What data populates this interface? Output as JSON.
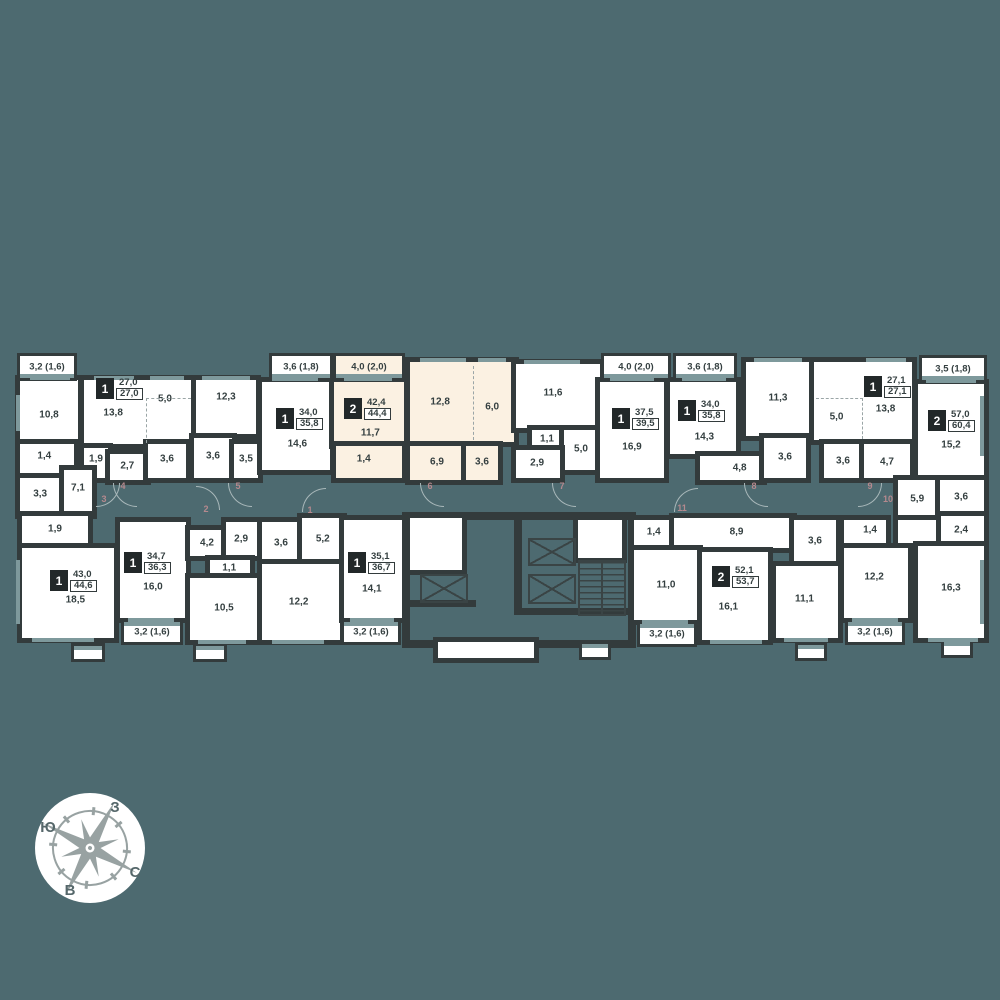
{
  "colors": {
    "bg": "#4d6a70",
    "wall": "#333b3c",
    "room": "#ffffff",
    "highlight": "#fbf1e2",
    "window": "#7e999c",
    "label": "#343f40",
    "flat_number": "#b5898e",
    "compass_star": "#98a2a2",
    "compass_text": "#55676a"
  },
  "highlighted_apartment": {
    "rooms_count": "2",
    "living_area": "42,4",
    "total_area": "44,4"
  },
  "plan": {
    "walls": [
      {
        "x": 402,
        "y": 512,
        "w": 234,
        "h": 8
      },
      {
        "x": 402,
        "y": 512,
        "w": 8,
        "h": 136
      },
      {
        "x": 628,
        "y": 512,
        "w": 8,
        "h": 136
      },
      {
        "x": 402,
        "y": 640,
        "w": 234,
        "h": 8
      },
      {
        "x": 514,
        "y": 512,
        "w": 8,
        "h": 96
      },
      {
        "x": 514,
        "y": 608,
        "w": 122,
        "h": 7
      },
      {
        "x": 404,
        "y": 600,
        "w": 72,
        "h": 7
      }
    ],
    "rooms": [
      {
        "x": 20,
        "y": 380,
        "w": 58,
        "h": 62,
        "l": [
          [
            "10,8",
            50,
            56
          ]
        ]
      },
      {
        "x": 84,
        "y": 380,
        "w": 108,
        "h": 64,
        "l": [
          [
            "13,8",
            27,
            52
          ],
          [
            "5,0",
            75,
            30
          ]
        ]
      },
      {
        "x": 196,
        "y": 380,
        "w": 60,
        "h": 54,
        "l": [
          [
            "12,3",
            50,
            32
          ]
        ]
      },
      {
        "x": 20,
        "y": 444,
        "w": 54,
        "h": 30,
        "l": [
          [
            "1,4",
            45,
            40
          ]
        ]
      },
      {
        "x": 84,
        "y": 448,
        "w": 24,
        "h": 30,
        "l": [
          [
            "1,9",
            50,
            35
          ]
        ]
      },
      {
        "x": 110,
        "y": 454,
        "w": 36,
        "h": 26,
        "l": [
          [
            "2,7",
            48,
            45
          ]
        ]
      },
      {
        "x": 148,
        "y": 444,
        "w": 38,
        "h": 34,
        "l": [
          [
            "3,6",
            50,
            45
          ]
        ]
      },
      {
        "x": 194,
        "y": 438,
        "w": 38,
        "h": 40,
        "l": [
          [
            "3,6",
            50,
            45
          ]
        ]
      },
      {
        "x": 234,
        "y": 444,
        "w": 24,
        "h": 34,
        "l": [
          [
            "3,5",
            50,
            45
          ]
        ]
      },
      {
        "x": 20,
        "y": 478,
        "w": 42,
        "h": 36,
        "l": [
          [
            "3,3",
            48,
            45
          ]
        ]
      },
      {
        "x": 64,
        "y": 470,
        "w": 28,
        "h": 44,
        "l": [
          [
            "7,1",
            50,
            40
          ]
        ]
      },
      {
        "x": 262,
        "y": 382,
        "w": 68,
        "h": 88,
        "l": [
          [
            "14,6",
            52,
            70
          ]
        ]
      },
      {
        "x": 334,
        "y": 382,
        "w": 70,
        "h": 62,
        "f": "b",
        "l": [
          [
            "11,7",
            52,
            82
          ]
        ]
      },
      {
        "x": 336,
        "y": 446,
        "w": 66,
        "h": 32,
        "f": "b",
        "l": [
          [
            "1,4",
            42,
            40
          ]
        ]
      },
      {
        "x": 410,
        "y": 362,
        "w": 104,
        "h": 80,
        "f": "b",
        "l": [
          [
            "12,8",
            29,
            50
          ],
          [
            "6,0",
            79,
            56
          ]
        ]
      },
      {
        "x": 410,
        "y": 446,
        "w": 54,
        "h": 34,
        "f": "b",
        "l": [
          [
            "6,9",
            50,
            48
          ]
        ]
      },
      {
        "x": 466,
        "y": 446,
        "w": 32,
        "h": 34,
        "f": "b",
        "l": [
          [
            "3,6",
            50,
            48
          ]
        ]
      },
      {
        "x": 516,
        "y": 364,
        "w": 84,
        "h": 64,
        "l": [
          [
            "11,6",
            44,
            45
          ]
        ]
      },
      {
        "x": 532,
        "y": 430,
        "w": 30,
        "h": 18,
        "l": [
          [
            "1,1",
            50,
            50
          ]
        ]
      },
      {
        "x": 564,
        "y": 430,
        "w": 34,
        "h": 40,
        "l": [
          [
            "5,0",
            50,
            48
          ]
        ]
      },
      {
        "x": 516,
        "y": 450,
        "w": 44,
        "h": 28,
        "l": [
          [
            "2,9",
            48,
            46
          ]
        ]
      },
      {
        "x": 600,
        "y": 382,
        "w": 64,
        "h": 96,
        "l": [
          [
            "16,9",
            50,
            68
          ]
        ]
      },
      {
        "x": 670,
        "y": 382,
        "w": 66,
        "h": 72,
        "l": [
          [
            "14,3",
            52,
            76
          ]
        ]
      },
      {
        "x": 700,
        "y": 456,
        "w": 62,
        "h": 24,
        "l": [
          [
            "4,8",
            64,
            48
          ]
        ]
      },
      {
        "x": 746,
        "y": 362,
        "w": 64,
        "h": 74,
        "l": [
          [
            "11,3",
            50,
            48
          ]
        ]
      },
      {
        "x": 764,
        "y": 438,
        "w": 42,
        "h": 40,
        "l": [
          [
            "3,6",
            50,
            48
          ]
        ]
      },
      {
        "x": 814,
        "y": 362,
        "w": 98,
        "h": 78,
        "l": [
          [
            "5,0",
            23,
            70
          ],
          [
            "13,8",
            73,
            60
          ]
        ]
      },
      {
        "x": 824,
        "y": 444,
        "w": 38,
        "h": 34,
        "l": [
          [
            "3,6",
            50,
            50
          ]
        ]
      },
      {
        "x": 864,
        "y": 444,
        "w": 46,
        "h": 34,
        "l": [
          [
            "4,7",
            50,
            52
          ]
        ]
      },
      {
        "x": 918,
        "y": 384,
        "w": 66,
        "h": 92,
        "l": [
          [
            "15,2",
            50,
            66
          ]
        ]
      },
      {
        "x": 898,
        "y": 480,
        "w": 40,
        "h": 36,
        "l": [
          [
            "5,9",
            48,
            52
          ]
        ]
      },
      {
        "x": 940,
        "y": 480,
        "w": 44,
        "h": 34,
        "l": [
          [
            "3,6",
            48,
            50
          ]
        ]
      },
      {
        "x": 940,
        "y": 516,
        "w": 44,
        "h": 26,
        "l": [
          [
            "2,4",
            48,
            52
          ]
        ]
      },
      {
        "x": 898,
        "y": 520,
        "w": 38,
        "h": 24,
        "l": []
      },
      {
        "x": 918,
        "y": 546,
        "w": 66,
        "h": 92,
        "l": [
          [
            "16,3",
            50,
            46
          ]
        ]
      },
      {
        "x": 22,
        "y": 516,
        "w": 66,
        "h": 28,
        "l": [
          [
            "1,9",
            50,
            48
          ]
        ]
      },
      {
        "x": 22,
        "y": 548,
        "w": 92,
        "h": 90,
        "l": [
          [
            "18,5",
            58,
            58
          ]
        ]
      },
      {
        "x": 120,
        "y": 522,
        "w": 66,
        "h": 96,
        "l": [
          [
            "16,0",
            50,
            68
          ]
        ]
      },
      {
        "x": 190,
        "y": 530,
        "w": 34,
        "h": 26,
        "l": [
          [
            "4,2",
            50,
            50
          ]
        ]
      },
      {
        "x": 226,
        "y": 522,
        "w": 36,
        "h": 34,
        "l": [
          [
            "2,9",
            42,
            50
          ]
        ]
      },
      {
        "x": 210,
        "y": 560,
        "w": 40,
        "h": 16,
        "l": [
          [
            "1,1",
            48,
            50
          ]
        ]
      },
      {
        "x": 190,
        "y": 578,
        "w": 68,
        "h": 62,
        "l": [
          [
            "10,5",
            50,
            48
          ]
        ]
      },
      {
        "x": 262,
        "y": 522,
        "w": 38,
        "h": 40,
        "l": [
          [
            "3,6",
            50,
            52
          ]
        ]
      },
      {
        "x": 302,
        "y": 518,
        "w": 40,
        "h": 42,
        "l": [
          [
            "5,2",
            52,
            50
          ]
        ]
      },
      {
        "x": 262,
        "y": 564,
        "w": 78,
        "h": 76,
        "l": [
          [
            "12,2",
            47,
            50
          ]
        ]
      },
      {
        "x": 344,
        "y": 520,
        "w": 58,
        "h": 98,
        "l": [
          [
            "14,1",
            48,
            70
          ]
        ]
      },
      {
        "x": 410,
        "y": 518,
        "w": 52,
        "h": 52,
        "l": []
      },
      {
        "x": 578,
        "y": 520,
        "w": 44,
        "h": 38,
        "l": []
      },
      {
        "x": 438,
        "y": 642,
        "w": 96,
        "h": 16,
        "l": []
      },
      {
        "x": 634,
        "y": 520,
        "w": 38,
        "h": 26,
        "l": [
          [
            "1,4",
            52,
            45
          ]
        ]
      },
      {
        "x": 674,
        "y": 518,
        "w": 118,
        "h": 30,
        "l": [
          [
            "8,9",
            53,
            48
          ]
        ]
      },
      {
        "x": 634,
        "y": 550,
        "w": 64,
        "h": 70,
        "l": [
          [
            "11,0",
            50,
            50
          ]
        ]
      },
      {
        "x": 702,
        "y": 552,
        "w": 66,
        "h": 88,
        "l": [
          [
            "16,1",
            40,
            62
          ]
        ]
      },
      {
        "x": 794,
        "y": 520,
        "w": 42,
        "h": 42,
        "l": [
          [
            "3,6",
            50,
            50
          ]
        ]
      },
      {
        "x": 776,
        "y": 566,
        "w": 62,
        "h": 72,
        "l": [
          [
            "11,1",
            46,
            46
          ]
        ]
      },
      {
        "x": 844,
        "y": 520,
        "w": 42,
        "h": 24,
        "l": [
          [
            "1,4",
            62,
            42
          ]
        ]
      },
      {
        "x": 844,
        "y": 548,
        "w": 64,
        "h": 70,
        "l": [
          [
            "12,2",
            47,
            42
          ]
        ]
      }
    ],
    "balconies": [
      {
        "t": "3,2 (1,6)",
        "x": 20,
        "y": 356,
        "w": 54,
        "h": 22,
        "side": "bottom"
      },
      {
        "t": "3,6 (1,8)",
        "x": 272,
        "y": 356,
        "w": 58,
        "h": 22,
        "side": "bottom"
      },
      {
        "t": "4,0 (2,0)",
        "x": 336,
        "y": 356,
        "w": 66,
        "h": 22,
        "side": "bottom",
        "hl": 1
      },
      {
        "t": "4,0 (2,0)",
        "x": 604,
        "y": 356,
        "w": 64,
        "h": 22,
        "side": "bottom"
      },
      {
        "t": "3,6 (1,8)",
        "x": 676,
        "y": 356,
        "w": 58,
        "h": 22,
        "side": "bottom"
      },
      {
        "t": "3,5 (1,8)",
        "x": 922,
        "y": 358,
        "w": 62,
        "h": 22,
        "side": "bottom"
      },
      {
        "t": "3,2 (1,6)",
        "x": 124,
        "y": 622,
        "w": 56,
        "h": 20,
        "side": "top"
      },
      {
        "t": "3,2 (1,6)",
        "x": 344,
        "y": 622,
        "w": 54,
        "h": 20,
        "side": "top"
      },
      {
        "t": "3,2 (1,6)",
        "x": 640,
        "y": 624,
        "w": 54,
        "h": 20,
        "side": "top"
      },
      {
        "t": "3,2 (1,6)",
        "x": 848,
        "y": 622,
        "w": 54,
        "h": 20,
        "side": "top"
      },
      {
        "t": "",
        "x": 74,
        "y": 646,
        "w": 28,
        "h": 13,
        "side": "top"
      },
      {
        "t": "",
        "x": 196,
        "y": 646,
        "w": 28,
        "h": 13,
        "side": "top"
      },
      {
        "t": "",
        "x": 582,
        "y": 644,
        "w": 26,
        "h": 13,
        "side": "top"
      },
      {
        "t": "",
        "x": 798,
        "y": 645,
        "w": 26,
        "h": 13,
        "side": "top"
      },
      {
        "t": "",
        "x": 944,
        "y": 642,
        "w": 26,
        "h": 13,
        "side": "top"
      }
    ],
    "badges": [
      {
        "n": "1",
        "a": "27,0",
        "tot": "27,0",
        "x": 96,
        "y": 378
      },
      {
        "n": "1",
        "a": "34,0",
        "tot": "35,8",
        "x": 276,
        "y": 408
      },
      {
        "n": "2",
        "a": "42,4",
        "tot": "44,4",
        "x": 344,
        "y": 398,
        "hl": 1
      },
      {
        "n": "1",
        "a": "37,5",
        "tot": "39,5",
        "x": 612,
        "y": 408
      },
      {
        "n": "1",
        "a": "34,0",
        "tot": "35,8",
        "x": 678,
        "y": 400
      },
      {
        "n": "1",
        "a": "27,1",
        "tot": "27,1",
        "x": 864,
        "y": 376
      },
      {
        "n": "2",
        "a": "57,0",
        "tot": "60,4",
        "x": 928,
        "y": 410
      },
      {
        "n": "1",
        "a": "43,0",
        "tot": "44,6",
        "x": 50,
        "y": 570
      },
      {
        "n": "1",
        "a": "34,7",
        "tot": "36,3",
        "x": 124,
        "y": 552
      },
      {
        "n": "1",
        "a": "35,1",
        "tot": "36,7",
        "x": 348,
        "y": 552
      },
      {
        "n": "2",
        "a": "52,1",
        "tot": "53,7",
        "x": 712,
        "y": 566
      }
    ],
    "flat_numbers": [
      {
        "n": "3",
        "x": 104,
        "y": 499
      },
      {
        "n": "4",
        "x": 123,
        "y": 486
      },
      {
        "n": "2",
        "x": 206,
        "y": 509
      },
      {
        "n": "5",
        "x": 238,
        "y": 486
      },
      {
        "n": "1",
        "x": 310,
        "y": 510
      },
      {
        "n": "6",
        "x": 430,
        "y": 486
      },
      {
        "n": "7",
        "x": 562,
        "y": 486
      },
      {
        "n": "11",
        "x": 682,
        "y": 508
      },
      {
        "n": "8",
        "x": 754,
        "y": 486
      },
      {
        "n": "9",
        "x": 870,
        "y": 486
      },
      {
        "n": "10",
        "x": 888,
        "y": 499
      }
    ],
    "windows": [
      {
        "x": 30,
        "y": 376,
        "w": 40,
        "h": 4
      },
      {
        "x": 94,
        "y": 376,
        "w": 40,
        "h": 4
      },
      {
        "x": 150,
        "y": 376,
        "w": 34,
        "h": 4
      },
      {
        "x": 202,
        "y": 376,
        "w": 48,
        "h": 4
      },
      {
        "x": 272,
        "y": 377,
        "w": 46,
        "h": 4
      },
      {
        "x": 344,
        "y": 377,
        "w": 48,
        "h": 4
      },
      {
        "x": 610,
        "y": 377,
        "w": 44,
        "h": 4
      },
      {
        "x": 682,
        "y": 377,
        "w": 44,
        "h": 4
      },
      {
        "x": 926,
        "y": 379,
        "w": 50,
        "h": 4
      },
      {
        "x": 420,
        "y": 358,
        "w": 46,
        "h": 4
      },
      {
        "x": 478,
        "y": 358,
        "w": 28,
        "h": 4
      },
      {
        "x": 524,
        "y": 360,
        "w": 56,
        "h": 4
      },
      {
        "x": 754,
        "y": 358,
        "w": 48,
        "h": 4
      },
      {
        "x": 866,
        "y": 358,
        "w": 40,
        "h": 4
      },
      {
        "x": 32,
        "y": 638,
        "w": 62,
        "h": 4
      },
      {
        "x": 128,
        "y": 618,
        "w": 46,
        "h": 4
      },
      {
        "x": 198,
        "y": 640,
        "w": 48,
        "h": 4
      },
      {
        "x": 272,
        "y": 640,
        "w": 52,
        "h": 4
      },
      {
        "x": 350,
        "y": 618,
        "w": 44,
        "h": 4
      },
      {
        "x": 642,
        "y": 620,
        "w": 46,
        "h": 4
      },
      {
        "x": 710,
        "y": 640,
        "w": 52,
        "h": 4
      },
      {
        "x": 784,
        "y": 638,
        "w": 44,
        "h": 4
      },
      {
        "x": 852,
        "y": 618,
        "w": 46,
        "h": 4
      },
      {
        "x": 928,
        "y": 638,
        "w": 50,
        "h": 4
      },
      {
        "x": 16,
        "y": 395,
        "w": 4,
        "h": 36
      },
      {
        "x": 16,
        "y": 560,
        "w": 4,
        "h": 64
      },
      {
        "x": 980,
        "y": 396,
        "w": 4,
        "h": 60
      },
      {
        "x": 980,
        "y": 560,
        "w": 4,
        "h": 64
      }
    ],
    "dashes": [
      {
        "x": 146,
        "y": 398,
        "w": 44,
        "h": 44,
        "s": "tl"
      },
      {
        "x": 473,
        "y": 366,
        "w": 1,
        "h": 74,
        "s": "l"
      },
      {
        "x": 816,
        "y": 398,
        "w": 46,
        "h": 40,
        "s": "tr"
      }
    ],
    "arcs": [
      {
        "cx": 96,
        "cy": 483,
        "q": 4
      },
      {
        "cx": 137,
        "cy": 483,
        "q": 3
      },
      {
        "cx": 196,
        "cy": 510,
        "q": 1
      },
      {
        "cx": 252,
        "cy": 483,
        "q": 3
      },
      {
        "cx": 326,
        "cy": 512,
        "q": 2
      },
      {
        "cx": 444,
        "cy": 483,
        "q": 3
      },
      {
        "cx": 576,
        "cy": 483,
        "q": 3
      },
      {
        "cx": 698,
        "cy": 512,
        "q": 2
      },
      {
        "cx": 768,
        "cy": 483,
        "q": 3
      },
      {
        "cx": 858,
        "cy": 483,
        "q": 4
      }
    ],
    "elevators": [
      {
        "x": 420,
        "y": 574,
        "w": 44,
        "h": 25
      },
      {
        "x": 528,
        "y": 538,
        "w": 44,
        "h": 24
      },
      {
        "x": 528,
        "y": 574,
        "w": 44,
        "h": 26
      }
    ],
    "stairs": {
      "x": 578,
      "y": 560,
      "w": 44,
      "h": 52
    }
  },
  "compass": {
    "north": "С",
    "south": "Ю",
    "east": "В",
    "west": "З"
  }
}
